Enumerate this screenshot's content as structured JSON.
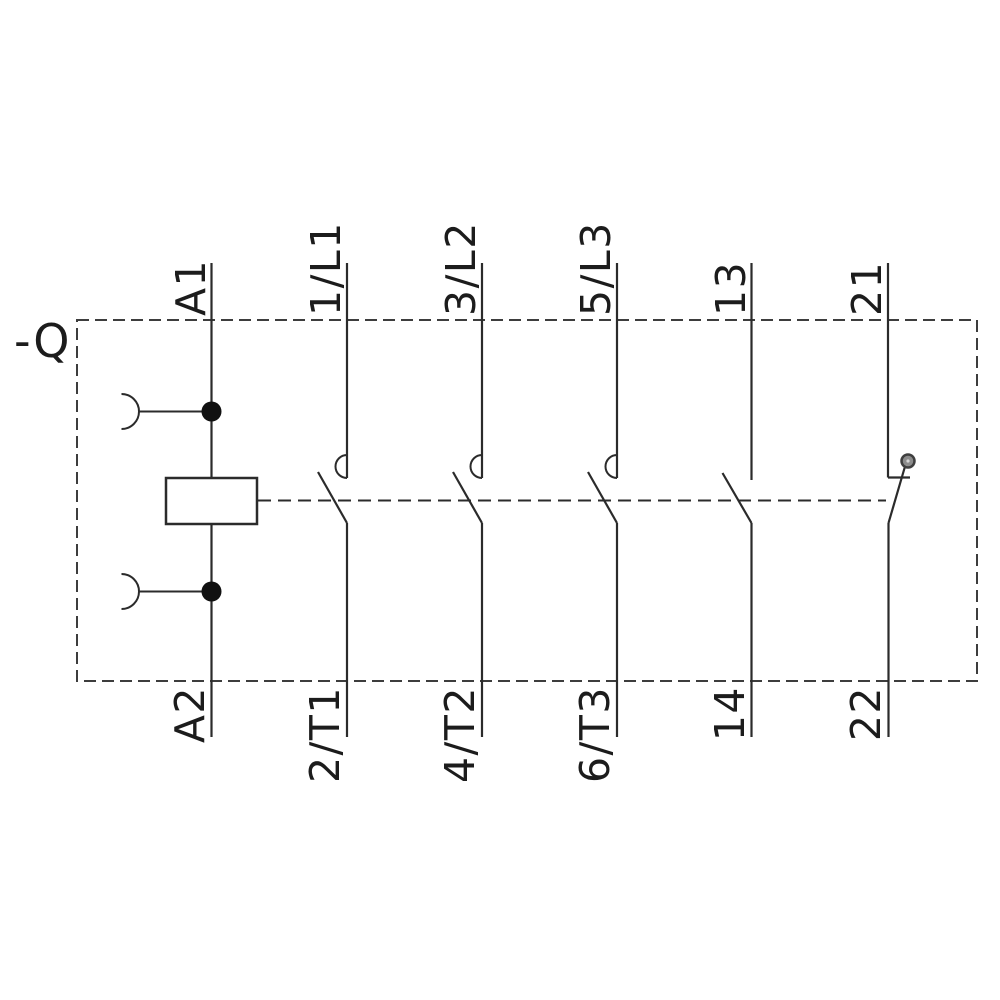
{
  "device": {
    "label": "-Q"
  },
  "poles": [
    {
      "kind": "coil",
      "top": "A1",
      "bottom": "A2"
    },
    {
      "kind": "main-no-contact",
      "top": "1/L1",
      "bottom": "2/T1"
    },
    {
      "kind": "main-no-contact",
      "top": "3/L2",
      "bottom": "4/T2"
    },
    {
      "kind": "main-no-contact",
      "top": "5/L3",
      "bottom": "6/T3"
    },
    {
      "kind": "aux-no-contact",
      "top": "13",
      "bottom": "14"
    },
    {
      "kind": "aux-nc-contact",
      "top": "21",
      "bottom": "22"
    }
  ],
  "colors": {
    "background": "#ffffff",
    "line": "#2b2b2b",
    "dashed_border": "#3d3d3d",
    "junction_dot": "#111111",
    "nc_marker_fill": "#8c8c8c",
    "nc_marker_ring": "#3f3f3f",
    "nc_marker_center": "#d4d4d4",
    "label_text": "#1c1c1c"
  }
}
